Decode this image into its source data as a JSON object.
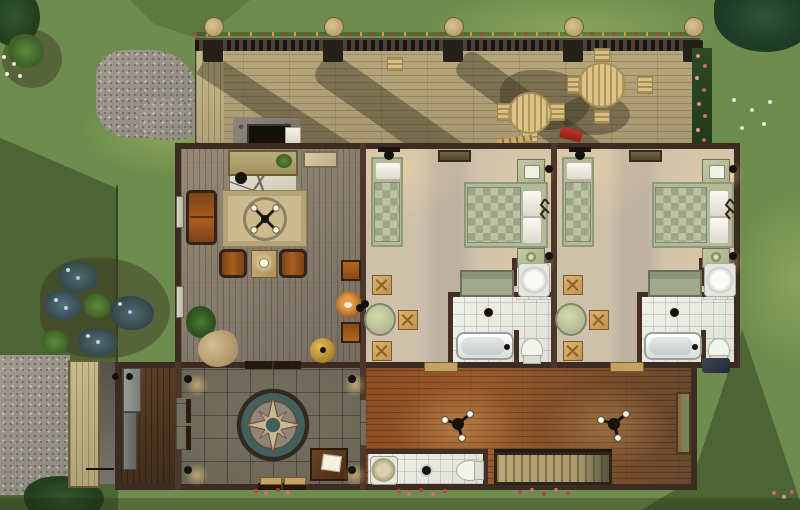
{
  "meta": {
    "description": "Top-down life-simulation game screenshot: floor plan of a country house with rear wooden deck",
    "canvas": {
      "width": 800,
      "height": 510
    },
    "visible_text": []
  },
  "palette": {
    "grass": "#6e8c4d",
    "grass_shadow": "#45602f",
    "gravel": "#9a948a",
    "deck_wood": "#b2a278",
    "exterior_wall": "#3d2a20",
    "interior_wall": "#4d362a",
    "living_room_floor": "#8a7e6d",
    "bedroom_carpet": "#cec1ab",
    "hallway_wood": "#8d4f24",
    "foyer_stone": "#6e6859",
    "bathroom_tile": "#ececе6",
    "bed_green": "#aab18d",
    "rug_beige": "#c9b98c",
    "compass_teal": "#44605e",
    "rose_pink": "#e0808f",
    "lamp_glow": "#ffd78c"
  },
  "scene": {
    "outdoor": {
      "items": [
        "tree-canopies",
        "tree-shadows",
        "gravel-paths",
        "flower-bed-purple",
        "rose-hedge",
        "red-flower-clusters",
        "garden-bushes",
        "string-lights",
        "deck-posts"
      ]
    },
    "upper_deck": {
      "items": [
        "patio-table-round",
        "patio-table-round",
        "slat-chairs",
        "fireplace-chimney",
        "firewood-pile",
        "toy-firetruck",
        "lattice-railing",
        "access-ramp"
      ]
    },
    "living_room": {
      "items": [
        "fireplace",
        "console-table",
        "wall-art-map",
        "oriental-rug",
        "ceiling-light-4-bulb",
        "leather-loveseat",
        "armchair",
        "armchair",
        "end-table-lamp",
        "potted-plant",
        "bean-bag",
        "dinette-chair",
        "dinette-chair",
        "cat-bed-with-cat",
        "brass-urn",
        "window",
        "window",
        "double-door-to-foyer"
      ]
    },
    "bedroom_1": {
      "items": [
        "single-bed",
        "double-bed",
        "nightstand-radio",
        "nightstand-flowers",
        "wall-plaque",
        "ceiling-lamp",
        "wall-sconces",
        "foot-bench",
        "antler-rack",
        "round-table",
        "x-stools",
        "ensuite-bathroom"
      ]
    },
    "bedroom_2": {
      "items": [
        "single-bed",
        "double-bed",
        "nightstand-radio",
        "nightstand-flowers",
        "wall-plaque",
        "ceiling-lamp",
        "wall-sconces",
        "foot-bench",
        "antler-rack",
        "round-table",
        "x-stools",
        "ensuite-bathroom"
      ]
    },
    "bathrooms": {
      "items": [
        "bathtub",
        "toilet",
        "pedestal-sink",
        "counter-sink",
        "ceiling-light"
      ]
    },
    "foyer": {
      "items": [
        "compass-rose-floor-medallion",
        "writing-desk",
        "wall-sconces",
        "double-door-west",
        "double-door-north",
        "door-mats"
      ]
    },
    "mudroom": {
      "items": [
        "gray-counter",
        "door-with-knobs",
        "dark-plank-floor"
      ]
    },
    "hallway": {
      "items": [
        "ceiling-light-3-bulb",
        "ceiling-light-3-bulb",
        "bench-green",
        "door-mat",
        "door-mat",
        "half-bathroom",
        "staircase-down"
      ]
    }
  }
}
